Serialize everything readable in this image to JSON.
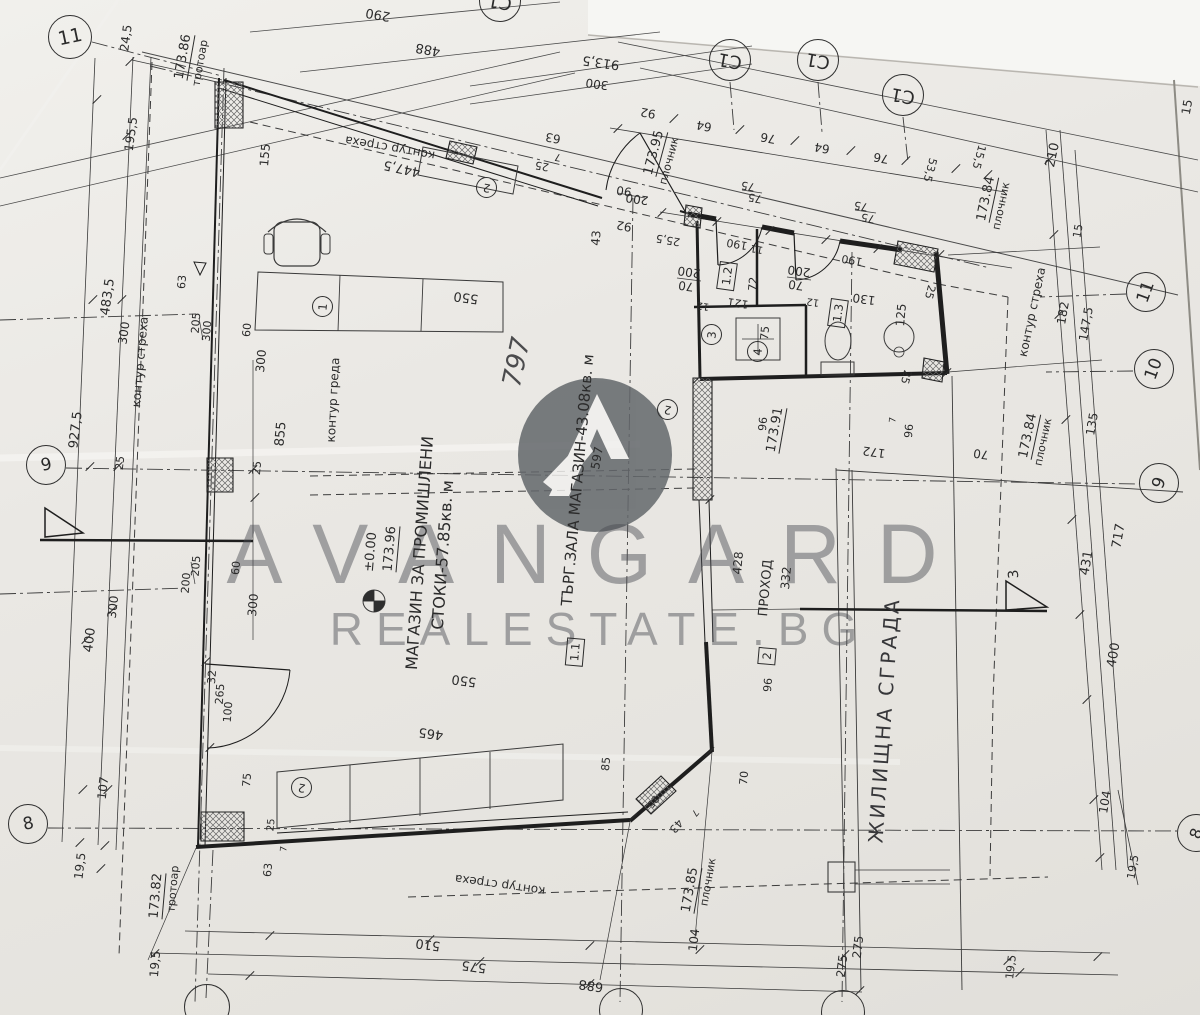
{
  "watermark": {
    "line1": "AVANGARD",
    "line2": "REALESTATE.BG"
  },
  "colors": {
    "paper": "#eae8e4",
    "ink": "#2b2b2b",
    "watermark_gray": "#63676b",
    "logo_circle": "#63676b"
  },
  "labels": [
    {
      "t": "290",
      "x": 378,
      "y": 14,
      "r": 190,
      "s": 13
    },
    {
      "t": "488",
      "x": 428,
      "y": 49,
      "r": 190,
      "s": 13
    },
    {
      "t": "913,5",
      "x": 601,
      "y": 62,
      "r": 188,
      "s": 13
    },
    {
      "t": "300",
      "x": 597,
      "y": 84,
      "r": 188,
      "s": 12
    },
    {
      "t": "92",
      "x": 648,
      "y": 113,
      "r": 190,
      "s": 12
    },
    {
      "t": "64",
      "x": 704,
      "y": 126,
      "r": 190,
      "s": 12
    },
    {
      "t": "76",
      "x": 768,
      "y": 138,
      "r": 190,
      "s": 12
    },
    {
      "t": "64",
      "x": 822,
      "y": 148,
      "r": 190,
      "s": 12
    },
    {
      "t": "76",
      "x": 881,
      "y": 158,
      "r": 190,
      "s": 12
    },
    {
      "t": "53,5",
      "x": 930,
      "y": 170,
      "r": 105,
      "s": 11
    },
    {
      "t": "15,5",
      "x": 979,
      "y": 157,
      "r": 105,
      "s": 11
    },
    {
      "t": "75",
      "x": 748,
      "y": 186,
      "r": 190,
      "s": 11
    },
    {
      "t": "75",
      "x": 755,
      "y": 198,
      "r": 190,
      "s": 11
    },
    {
      "t": "75",
      "x": 861,
      "y": 206,
      "r": 190,
      "s": 11
    },
    {
      "t": "75",
      "x": 868,
      "y": 218,
      "r": 190,
      "s": 11
    },
    {
      "t": "25,5",
      "x": 668,
      "y": 240,
      "r": 190,
      "s": 11
    },
    {
      "t": "190",
      "x": 737,
      "y": 244,
      "r": 190,
      "s": 11
    },
    {
      "t": "11",
      "x": 757,
      "y": 248,
      "r": 190,
      "s": 10
    },
    {
      "t": "190",
      "x": 852,
      "y": 260,
      "r": 190,
      "s": 11
    },
    {
      "t": "90",
      "x": 624,
      "y": 191,
      "r": 188,
      "s": 12
    },
    {
      "t": "200",
      "x": 637,
      "y": 199,
      "r": 188,
      "s": 12
    },
    {
      "t": "92",
      "x": 624,
      "y": 226,
      "r": 190,
      "s": 12
    },
    {
      "t": "43",
      "x": 596,
      "y": 238,
      "r": -85,
      "s": 12
    },
    {
      "t": "63",
      "x": 553,
      "y": 138,
      "r": 190,
      "s": 12
    },
    {
      "t": "25",
      "x": 542,
      "y": 166,
      "r": 190,
      "s": 11
    },
    {
      "t": "7",
      "x": 558,
      "y": 156,
      "r": 190,
      "s": 10
    },
    {
      "t": "447,5",
      "x": 402,
      "y": 168,
      "r": 192,
      "s": 13
    },
    {
      "t": "155",
      "x": 265,
      "y": 155,
      "r": -85,
      "s": 12
    },
    {
      "t": "173.86",
      "x": 184,
      "y": 57,
      "r": -80,
      "s": 13,
      "c": "lvl"
    },
    {
      "t": "тротоар",
      "x": 200,
      "y": 63,
      "r": -80,
      "s": 11
    },
    {
      "t": "контур стреха",
      "x": 390,
      "y": 148,
      "r": 190,
      "s": 12
    },
    {
      "t": "173.95",
      "x": 655,
      "y": 153,
      "r": -75,
      "s": 13,
      "c": "lvl"
    },
    {
      "t": "плочник",
      "x": 669,
      "y": 161,
      "r": -75,
      "s": 11
    },
    {
      "t": "173.84",
      "x": 987,
      "y": 199,
      "r": -78,
      "s": 13,
      "c": "lvl"
    },
    {
      "t": "плочник",
      "x": 1001,
      "y": 206,
      "r": -78,
      "s": 11
    },
    {
      "t": "210",
      "x": 1053,
      "y": 155,
      "r": -78,
      "s": 13
    },
    {
      "t": "15",
      "x": 1187,
      "y": 107,
      "r": -80,
      "s": 12
    },
    {
      "t": "15",
      "x": 1078,
      "y": 231,
      "r": -80,
      "s": 11
    },
    {
      "t": "контур стреха",
      "x": 1032,
      "y": 312,
      "r": -78,
      "s": 12
    },
    {
      "t": "182",
      "x": 1063,
      "y": 313,
      "r": -80,
      "s": 12
    },
    {
      "t": "147,5",
      "x": 1086,
      "y": 324,
      "r": -80,
      "s": 12
    },
    {
      "t": "25",
      "x": 930,
      "y": 292,
      "r": 105,
      "s": 11
    },
    {
      "t": "25",
      "x": 906,
      "y": 377,
      "r": 105,
      "s": 11
    },
    {
      "t": "125",
      "x": 901,
      "y": 315,
      "r": -85,
      "s": 12
    },
    {
      "t": "130",
      "x": 864,
      "y": 299,
      "r": 188,
      "s": 12
    },
    {
      "t": "12",
      "x": 813,
      "y": 301,
      "r": 188,
      "s": 10
    },
    {
      "t": "121",
      "x": 738,
      "y": 303,
      "r": 188,
      "s": 11
    },
    {
      "t": "12",
      "x": 703,
      "y": 305,
      "r": 188,
      "s": 10
    },
    {
      "t": "200",
      "x": 799,
      "y": 271,
      "r": 188,
      "s": 12
    },
    {
      "t": "70",
      "x": 796,
      "y": 285,
      "r": 188,
      "s": 12
    },
    {
      "t": "200",
      "x": 689,
      "y": 272,
      "r": 188,
      "s": 12
    },
    {
      "t": "70",
      "x": 686,
      "y": 286,
      "r": 188,
      "s": 12
    },
    {
      "t": "72",
      "x": 753,
      "y": 284,
      "r": -85,
      "s": 11
    },
    {
      "t": "75",
      "x": 765,
      "y": 333,
      "r": -85,
      "s": 11
    },
    {
      "t": "24,5",
      "x": 126,
      "y": 38,
      "r": -82,
      "s": 12
    },
    {
      "t": "195,5",
      "x": 131,
      "y": 134,
      "r": -82,
      "s": 12
    },
    {
      "t": "483,5",
      "x": 108,
      "y": 297,
      "r": -82,
      "s": 13
    },
    {
      "t": "300",
      "x": 124,
      "y": 333,
      "r": -82,
      "s": 12
    },
    {
      "t": "927,5",
      "x": 76,
      "y": 430,
      "r": -83,
      "s": 13
    },
    {
      "t": "25",
      "x": 120,
      "y": 463,
      "r": -83,
      "s": 11
    },
    {
      "t": "контур стреха",
      "x": 140,
      "y": 362,
      "r": -85,
      "s": 12
    },
    {
      "t": "205",
      "x": 196,
      "y": 323,
      "r": -85,
      "s": 11
    },
    {
      "t": "300",
      "x": 207,
      "y": 331,
      "r": -85,
      "s": 11
    },
    {
      "t": "60",
      "x": 247,
      "y": 330,
      "r": -85,
      "s": 11
    },
    {
      "t": "300",
      "x": 261,
      "y": 361,
      "r": -85,
      "s": 12
    },
    {
      "t": "855",
      "x": 281,
      "y": 434,
      "r": -85,
      "s": 13
    },
    {
      "t": "контур греда",
      "x": 333,
      "y": 400,
      "r": -87,
      "s": 12
    },
    {
      "t": "63",
      "x": 182,
      "y": 282,
      "r": -85,
      "s": 11
    },
    {
      "t": "25",
      "x": 257,
      "y": 468,
      "r": -85,
      "s": 11
    },
    {
      "t": "550",
      "x": 466,
      "y": 297,
      "r": 188,
      "s": 13
    },
    {
      "t": "597",
      "x": 597,
      "y": 458,
      "r": -80,
      "s": 12
    },
    {
      "t": "797",
      "x": 517,
      "y": 362,
      "r": -78,
      "s": 26,
      "c": "hw"
    },
    {
      "t": "±0.00",
      "x": 371,
      "y": 552,
      "r": -85,
      "s": 13
    },
    {
      "t": "173.96",
      "x": 391,
      "y": 549,
      "r": -85,
      "s": 13,
      "c": "lvl"
    },
    {
      "t": "МАГАЗИН ЗА ПРОМИШЛЕНИ",
      "x": 420,
      "y": 553,
      "r": -86,
      "s": 16
    },
    {
      "t": "СТОКИ-57.85кв. м",
      "x": 443,
      "y": 555,
      "r": -86,
      "s": 16
    },
    {
      "t": "ТЪРГ.ЗАЛА МАГАЗИН-43.08кв. м",
      "x": 578,
      "y": 480,
      "r": -85,
      "s": 15
    },
    {
      "t": "173.91",
      "x": 776,
      "y": 430,
      "r": -80,
      "s": 13,
      "c": "lvl"
    },
    {
      "t": "172",
      "x": 874,
      "y": 452,
      "r": 188,
      "s": 12
    },
    {
      "t": "70",
      "x": 981,
      "y": 454,
      "r": 188,
      "s": 12
    },
    {
      "t": "96",
      "x": 909,
      "y": 431,
      "r": -85,
      "s": 11
    },
    {
      "t": "7",
      "x": 894,
      "y": 420,
      "r": -85,
      "s": 9
    },
    {
      "t": "96",
      "x": 763,
      "y": 424,
      "r": -85,
      "s": 11
    },
    {
      "t": "173.84",
      "x": 1029,
      "y": 436,
      "r": -78,
      "s": 13,
      "c": "lvl"
    },
    {
      "t": "плочник",
      "x": 1043,
      "y": 442,
      "r": -78,
      "s": 11
    },
    {
      "t": "135",
      "x": 1092,
      "y": 424,
      "r": -80,
      "s": 12
    },
    {
      "t": "717",
      "x": 1119,
      "y": 536,
      "r": -80,
      "s": 13
    },
    {
      "t": "431",
      "x": 1087,
      "y": 563,
      "r": -80,
      "s": 13
    },
    {
      "t": "428",
      "x": 738,
      "y": 563,
      "r": -85,
      "s": 12
    },
    {
      "t": "332",
      "x": 786,
      "y": 578,
      "r": -85,
      "s": 12
    },
    {
      "t": "ПРОХОД",
      "x": 766,
      "y": 588,
      "r": -85,
      "s": 13
    },
    {
      "t": "ЖИЛИЩНА СГРАДА",
      "x": 884,
      "y": 720,
      "r": -86,
      "s": 20,
      "c": "big"
    },
    {
      "t": "205",
      "x": 196,
      "y": 566,
      "r": -85,
      "s": 11
    },
    {
      "t": "200",
      "x": 186,
      "y": 583,
      "r": -85,
      "s": 11
    },
    {
      "t": "60",
      "x": 236,
      "y": 568,
      "r": -85,
      "s": 11
    },
    {
      "t": "300",
      "x": 253,
      "y": 605,
      "r": -85,
      "s": 12
    },
    {
      "t": "300",
      "x": 113,
      "y": 607,
      "r": -83,
      "s": 12
    },
    {
      "t": "400",
      "x": 90,
      "y": 640,
      "r": -83,
      "s": 13
    },
    {
      "t": "32",
      "x": 212,
      "y": 677,
      "r": -85,
      "s": 11
    },
    {
      "t": "265",
      "x": 220,
      "y": 694,
      "r": -85,
      "s": 11
    },
    {
      "t": "100",
      "x": 228,
      "y": 712,
      "r": -85,
      "s": 11
    },
    {
      "t": "107",
      "x": 103,
      "y": 788,
      "r": -83,
      "s": 12
    },
    {
      "t": "19,5",
      "x": 80,
      "y": 866,
      "r": -83,
      "s": 12
    },
    {
      "t": "75",
      "x": 247,
      "y": 780,
      "r": -85,
      "s": 11
    },
    {
      "t": "465",
      "x": 431,
      "y": 733,
      "r": 188,
      "s": 13
    },
    {
      "t": "550",
      "x": 464,
      "y": 680,
      "r": 188,
      "s": 13
    },
    {
      "t": "25",
      "x": 272,
      "y": 825,
      "r": -85,
      "s": 10
    },
    {
      "t": "7",
      "x": 285,
      "y": 849,
      "r": -85,
      "s": 9
    },
    {
      "t": "63",
      "x": 268,
      "y": 870,
      "r": -85,
      "s": 11
    },
    {
      "t": "85",
      "x": 606,
      "y": 764,
      "r": -85,
      "s": 11
    },
    {
      "t": "70",
      "x": 744,
      "y": 778,
      "r": -85,
      "s": 11
    },
    {
      "t": "96",
      "x": 768,
      "y": 685,
      "r": -85,
      "s": 11
    },
    {
      "t": "25",
      "x": 652,
      "y": 801,
      "r": 130,
      "s": 10
    },
    {
      "t": "43",
      "x": 676,
      "y": 826,
      "r": 130,
      "s": 11
    },
    {
      "t": "7",
      "x": 694,
      "y": 812,
      "r": 130,
      "s": 9
    },
    {
      "t": "контур стреха",
      "x": 500,
      "y": 885,
      "r": 188,
      "s": 12
    },
    {
      "t": "173.85",
      "x": 691,
      "y": 890,
      "r": -80,
      "s": 13,
      "c": "lvl"
    },
    {
      "t": "плочник",
      "x": 708,
      "y": 882,
      "r": -80,
      "s": 11
    },
    {
      "t": "173.82",
      "x": 157,
      "y": 896,
      "r": -85,
      "s": 13,
      "c": "lvl"
    },
    {
      "t": "тротоар",
      "x": 173,
      "y": 889,
      "r": -85,
      "s": 11
    },
    {
      "t": "19,5",
      "x": 155,
      "y": 964,
      "r": -85,
      "s": 12
    },
    {
      "t": "510",
      "x": 428,
      "y": 944,
      "r": 188,
      "s": 13
    },
    {
      "t": "575",
      "x": 474,
      "y": 966,
      "r": 188,
      "s": 13
    },
    {
      "t": "688",
      "x": 591,
      "y": 985,
      "r": 188,
      "s": 13
    },
    {
      "t": "104",
      "x": 694,
      "y": 940,
      "r": -83,
      "s": 12
    },
    {
      "t": "275",
      "x": 858,
      "y": 947,
      "r": -83,
      "s": 12
    },
    {
      "t": "275",
      "x": 842,
      "y": 966,
      "r": -83,
      "s": 12
    },
    {
      "t": "19,5",
      "x": 1011,
      "y": 967,
      "r": -83,
      "s": 11
    },
    {
      "t": "104",
      "x": 1105,
      "y": 802,
      "r": -80,
      "s": 12
    },
    {
      "t": "400",
      "x": 1114,
      "y": 655,
      "r": -80,
      "s": 13
    },
    {
      "t": "19,5",
      "x": 1133,
      "y": 867,
      "r": -80,
      "s": 11
    },
    {
      "t": "3",
      "x": 1014,
      "y": 574,
      "r": -95,
      "s": 14
    }
  ],
  "bubbles": [
    {
      "t": "11",
      "x": 70,
      "y": 37,
      "rad": 22,
      "tr": -12
    },
    {
      "t": "9",
      "x": 46,
      "y": 465,
      "rad": 20,
      "tr": -12
    },
    {
      "t": "8",
      "x": 28,
      "y": 824,
      "rad": 20,
      "tr": -12
    },
    {
      "t": "С1",
      "x": 730,
      "y": 60,
      "rad": 21,
      "tr": 190
    },
    {
      "t": "С1",
      "x": 818,
      "y": 60,
      "rad": 21,
      "tr": 190
    },
    {
      "t": "С1",
      "x": 903,
      "y": 95,
      "rad": 21,
      "tr": 190
    },
    {
      "t": "С1",
      "x": 500,
      "y": 1,
      "rad": 21,
      "tr": 190
    },
    {
      "t": "11",
      "x": 1146,
      "y": 292,
      "rad": 20,
      "tr": -70
    },
    {
      "t": "10",
      "x": 1154,
      "y": 369,
      "rad": 20,
      "tr": -70
    },
    {
      "t": "9",
      "x": 1159,
      "y": 483,
      "rad": 20,
      "tr": -70
    },
    {
      "t": "8",
      "x": 1196,
      "y": 833,
      "rad": 19,
      "tr": -70
    },
    {
      "t": "",
      "x": 207,
      "y": 1007,
      "rad": 23,
      "tr": 0
    },
    {
      "t": "",
      "x": 621,
      "y": 1010,
      "rad": 22,
      "tr": 0
    },
    {
      "t": "",
      "x": 843,
      "y": 1012,
      "rad": 22,
      "tr": 0
    }
  ],
  "tags": [
    {
      "t": "1",
      "x": 323,
      "y": 307,
      "r": -85
    },
    {
      "t": "2",
      "x": 487,
      "y": 188,
      "r": 190
    },
    {
      "t": "2",
      "x": 668,
      "y": 410,
      "r": 190
    },
    {
      "t": "2",
      "x": 302,
      "y": 788,
      "r": 190
    },
    {
      "t": "3",
      "x": 712,
      "y": 335,
      "r": -85
    },
    {
      "t": "4",
      "x": 758,
      "y": 352,
      "r": -85
    }
  ],
  "boxes": [
    {
      "t": "1.2",
      "x": 727,
      "y": 276,
      "r": -82
    },
    {
      "t": "1.3",
      "x": 838,
      "y": 313,
      "r": -82
    },
    {
      "t": "2",
      "x": 767,
      "y": 656,
      "r": -85
    },
    {
      "t": "1.1",
      "x": 575,
      "y": 652,
      "r": -85
    }
  ]
}
